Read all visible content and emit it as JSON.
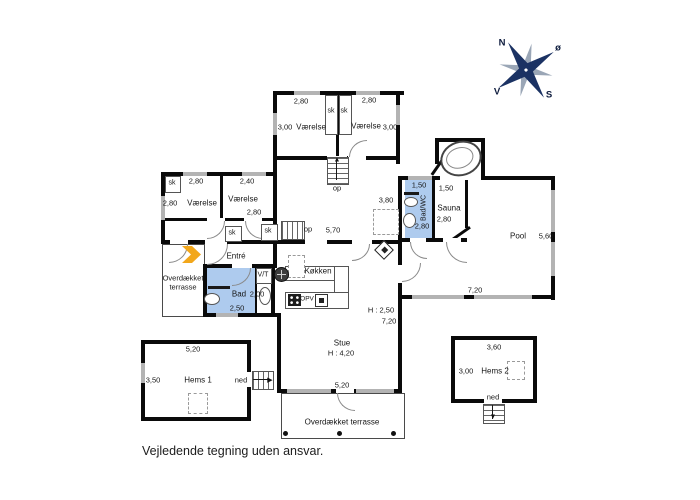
{
  "meta": {
    "disclaimer": "Vejledende tegning uden ansvar."
  },
  "compass": {
    "n": "N",
    "e": "ø",
    "s": "S",
    "v": "V"
  },
  "shared": {
    "closet": "sk",
    "stairs_up": "op",
    "stairs_down": "ned"
  },
  "colors": {
    "wall": "#0a0a0a",
    "wet_room": "#aecbee",
    "window": "#b3b3b3",
    "entrance_arrow": "#f2a71b",
    "compass_star": "#1b3263"
  },
  "rooms": {
    "bedroom_ne1": {
      "name": "Værelse",
      "w": "2,80",
      "d": "3,00"
    },
    "bedroom_ne2": {
      "name": "Værelse",
      "w": "2,80",
      "d": "3,00"
    },
    "bedroom_w1": {
      "name": "Værelse",
      "w": "2,80",
      "d": "2,80"
    },
    "bedroom_w2": {
      "name": "Værelse",
      "w": "2,40",
      "d": "2,80"
    },
    "hall": {
      "w": "5,70",
      "d": "3,80"
    },
    "entre": {
      "name": "Entré"
    },
    "bad": {
      "name": "Bad",
      "w": "2,00",
      "d": "2,50"
    },
    "vt": {
      "name": "V/T"
    },
    "kitchen": {
      "name": "Køkken",
      "dishwasher": "OPV"
    },
    "stue": {
      "name": "Stue",
      "ceiling": "H : 4,20",
      "ceiling_low": "H : 2,50",
      "w": "7,20",
      "terrace_w": "5,20"
    },
    "badwc": {
      "name": "Bad/WC",
      "w": "1,50",
      "d": "2,80"
    },
    "sauna": {
      "name": "Sauna",
      "w": "1,50",
      "d": "2,80"
    },
    "pool": {
      "name": "Pool",
      "w": "7,20",
      "d": "5,60"
    },
    "hems1": {
      "name": "Hems 1",
      "w": "5,20",
      "d": "3,50"
    },
    "hems2": {
      "name": "Hems 2",
      "w": "3,60",
      "d": "3,00"
    },
    "terrace_west": {
      "name": "Overdækket terrasse"
    },
    "terrace_south": {
      "name": "Overdækket terrasse"
    }
  }
}
